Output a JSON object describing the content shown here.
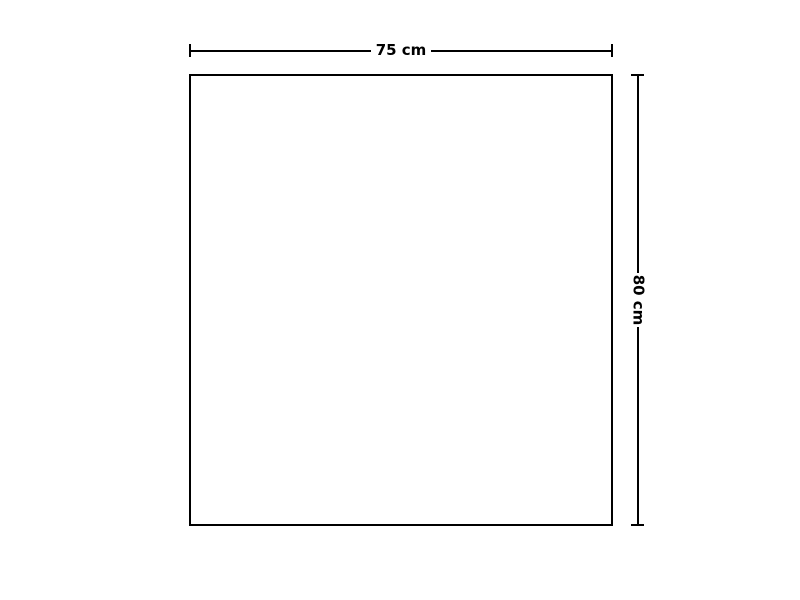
{
  "diagram": {
    "type": "dimension-drawing",
    "shape": "rectangle",
    "width_dimension": {
      "label": "75 cm",
      "value": 75,
      "unit": "cm",
      "position": "top"
    },
    "height_dimension": {
      "label": "80 cm",
      "value": 80,
      "unit": "cm",
      "position": "right",
      "label_rotation_deg": 90
    },
    "colors": {
      "line": "#000000",
      "text": "#000000",
      "background": "#ffffff",
      "shape_fill": "#ffffff"
    }
  }
}
